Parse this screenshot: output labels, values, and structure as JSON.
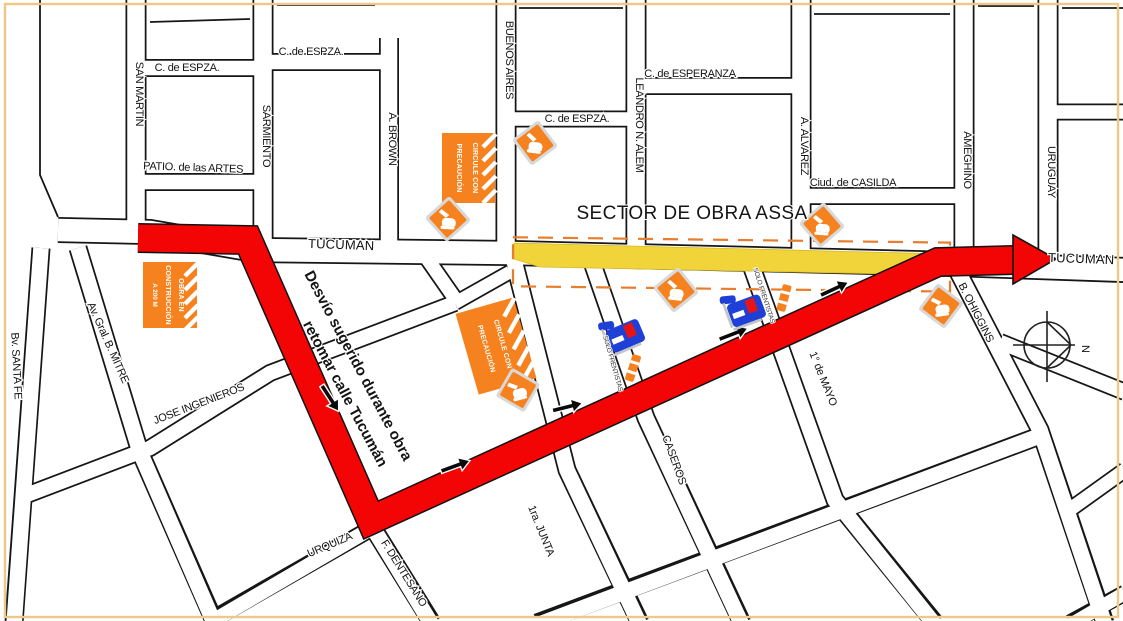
{
  "map": {
    "type": "street-detour-map",
    "streets": [
      "SAN MARTIN",
      "C. de ESPZA.",
      "C. de ESPZA.",
      "C. de ESPZA.",
      "C. de ESPERANZA",
      "SARMIENTO",
      "A. BROWN",
      "BUENOS AIRES",
      "LEANDRO N. ALEM",
      "A. ALVAREZ",
      "Ciud. de CASILDA",
      "AMEGHINO",
      "URUGUAY",
      "PATIO. de las ARTES",
      "TUCUMAN",
      "TUCUMAN",
      "Bv. SANTA FE",
      "Av. Gral. B. MITRE",
      "JOSE INGENIEROS",
      "URQUIZA",
      "F. DENTESANO",
      "1ra. JUNTA",
      "CASEROS",
      "1° de MAYO",
      "B. OHIGGINS"
    ],
    "annotations": {
      "sector_label": "SECTOR DE OBRA ASSA",
      "detour_line1": "Desvío sugerido durante obra",
      "detour_line2": "retomar calle Tucumán",
      "solo_frentistas": "SOLO FRENTISTAS",
      "north_letter": "N"
    },
    "signs": {
      "circule_line1": "CIRCULE CON",
      "circule_line2": "PRECAUCIÓN",
      "obra_line1": "OBRA EN",
      "obra_line2": "CONSTRUCCIÓN",
      "obra_line3": "A 200 M"
    },
    "icons": {
      "warning_diamond": "excavator-works-icon",
      "machine": "construction-machine-icon",
      "barrier": "work-barrier-icon",
      "compass": "north-compass-icon",
      "detour_arrowhead": "direction-arrow-icon"
    },
    "colors": {
      "detour_red": "#F40505",
      "work_zone_yellow": "#F0D43A",
      "sign_orange": "#F5821F",
      "dashed_outline_orange": "#E87D2E",
      "machine_blue": "#1E40D6",
      "machine_red": "#E61414",
      "street_line": "#161616",
      "page_border": "#ECC987"
    }
  }
}
